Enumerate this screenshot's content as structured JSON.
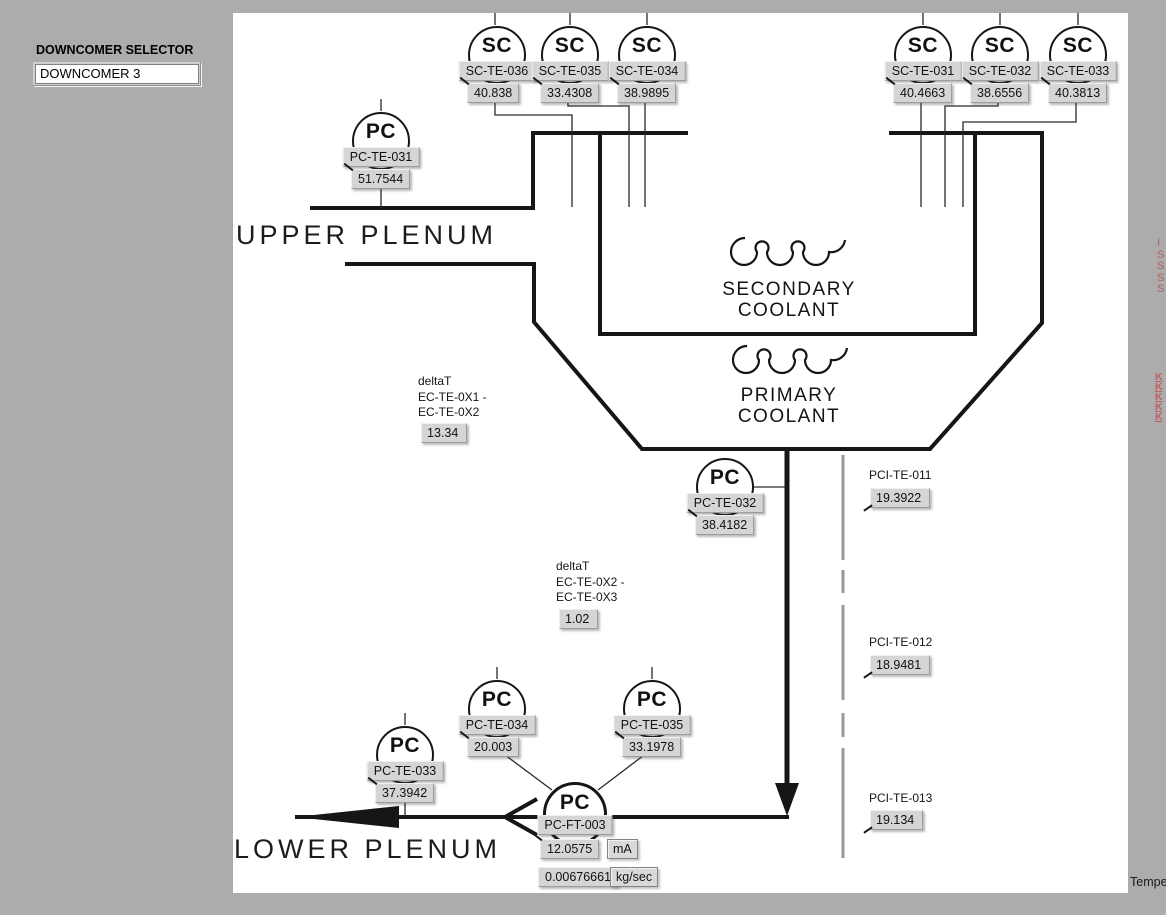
{
  "selector": {
    "label": "DOWNCOMER SELECTOR",
    "value": "DOWNCOMER 3"
  },
  "diagram": {
    "upper_plenum": "UPPER PLENUM",
    "lower_plenum": "LOWER PLENUM",
    "secondary_coolant": "SECONDARY\nCOOLANT",
    "primary_coolant": "PRIMARY\nCOOLANT"
  },
  "sensors": [
    {
      "symbol": "SC",
      "tag": "SC-TE-036",
      "value": "40.838"
    },
    {
      "symbol": "SC",
      "tag": "SC-TE-035",
      "value": "33.4308"
    },
    {
      "symbol": "SC",
      "tag": "SC-TE-034",
      "value": "38.9895"
    },
    {
      "symbol": "SC",
      "tag": "SC-TE-031",
      "value": "40.4663"
    },
    {
      "symbol": "SC",
      "tag": "SC-TE-032",
      "value": "38.6556"
    },
    {
      "symbol": "SC",
      "tag": "SC-TE-033",
      "value": "40.3813"
    },
    {
      "symbol": "PC",
      "tag": "PC-TE-031",
      "value": "51.7544"
    },
    {
      "symbol": "PC",
      "tag": "PC-TE-032",
      "value": "38.4182"
    },
    {
      "symbol": "PC",
      "tag": "PC-TE-034",
      "value": "20.003"
    },
    {
      "symbol": "PC",
      "tag": "PC-TE-035",
      "value": "33.1978"
    },
    {
      "symbol": "PC",
      "tag": "PC-TE-033",
      "value": "37.3942"
    }
  ],
  "flow_sensor": {
    "symbol": "PC",
    "tag": "PC-FT-003",
    "current": "12.0575",
    "current_unit": "mA",
    "flow": "0.00676661",
    "flow_unit": "kg/sec"
  },
  "delta_t": [
    {
      "text": "deltaT\nEC-TE-0X1 -\nEC-TE-0X2",
      "value": "13.34"
    },
    {
      "text": "deltaT\nEC-TE-0X2 -\nEC-TE-0X3",
      "value": "1.02"
    }
  ],
  "pci": [
    {
      "tag": "PCI-TE-011",
      "value": "19.3922"
    },
    {
      "tag": "PCI-TE-012",
      "value": "18.9481"
    },
    {
      "tag": "PCI-TE-013",
      "value": "19.134"
    }
  ],
  "clipped_right": {
    "group1": "I\nS\nS\nS\nS",
    "group2": "K\nK\nK\nK\nK"
  },
  "corner_text": "Tempe",
  "colors": {
    "background": "#acacac",
    "panel": "#ffffff",
    "box_gray": "#d5d5d5",
    "line_black": "#161616",
    "dashed_gray": "#999999",
    "clipped_red": "#b35a5a"
  }
}
